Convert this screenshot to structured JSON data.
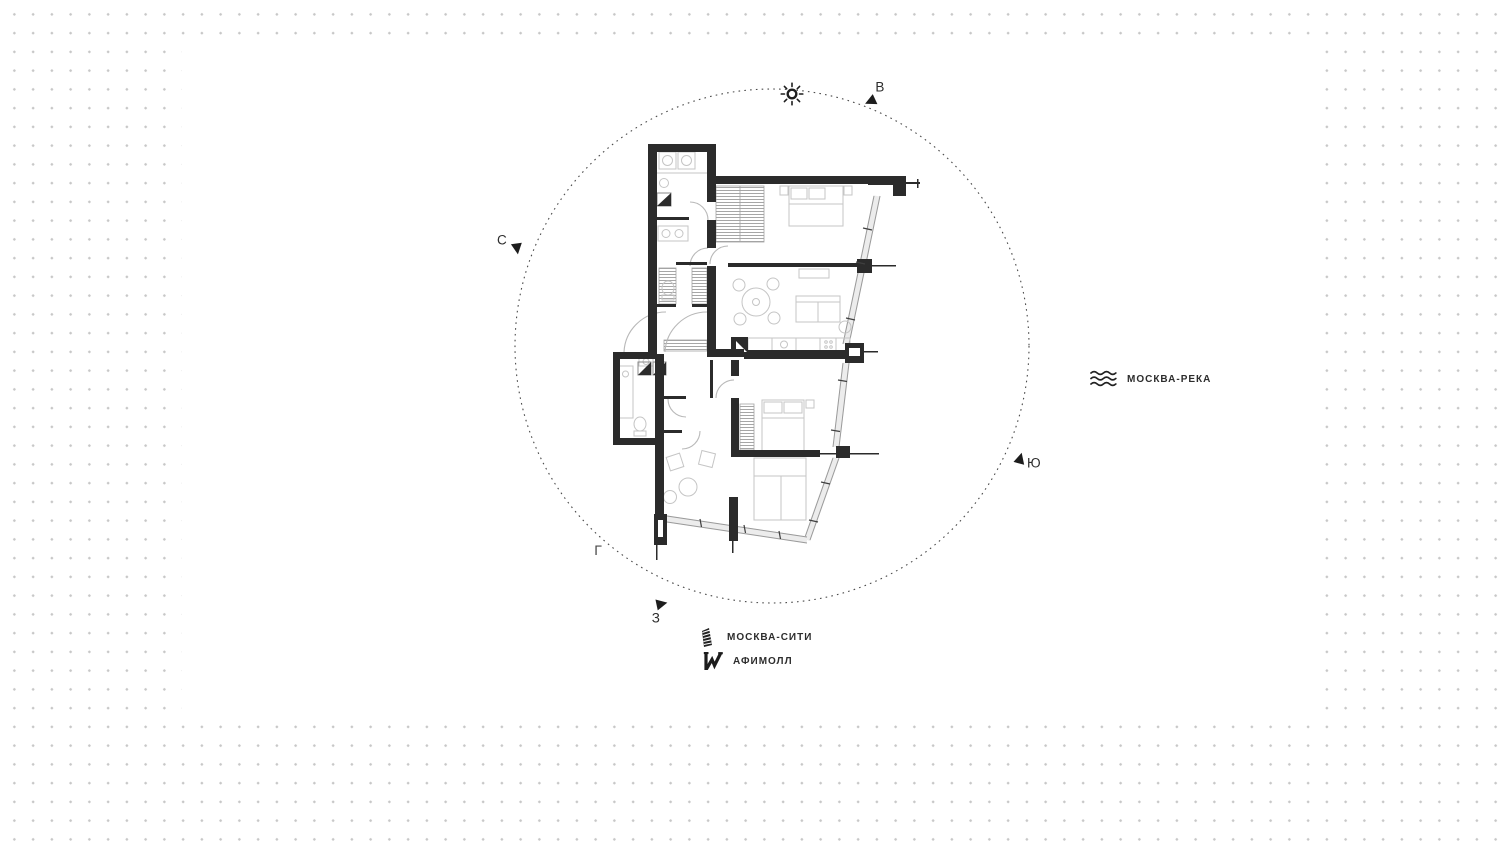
{
  "canvas": {
    "type": "floor-plan-view",
    "colors": {
      "dots": "#c7c7c7",
      "card": "#ffffff",
      "walls": "#2b2b2b",
      "furniture": "#c5c5c5",
      "glazing": "#ececec"
    }
  },
  "compass": {
    "circle_style": "dashed",
    "sun_icon": "sun-icon",
    "directions": [
      {
        "id": "east",
        "label": "В",
        "arrow_icon": "east-arrow-icon"
      },
      {
        "id": "north",
        "label": "С",
        "arrow_icon": "north-arrow-icon"
      },
      {
        "id": "south",
        "label": "Ю",
        "arrow_icon": "south-arrow-icon"
      },
      {
        "id": "west",
        "label": "З",
        "arrow_icon": "west-arrow-icon"
      }
    ]
  },
  "plan": {
    "grid_axis_mark": "Г"
  },
  "landmarks": {
    "river": {
      "label": "МОСКВА-РЕКА",
      "icon": "river-waves-icon"
    },
    "city": {
      "label": "МОСКВА-СИТИ",
      "icon": "moscow-city-tower-icon"
    },
    "mall": {
      "label": "АФИМОЛЛ",
      "icon": "afimall-logo-icon"
    }
  }
}
